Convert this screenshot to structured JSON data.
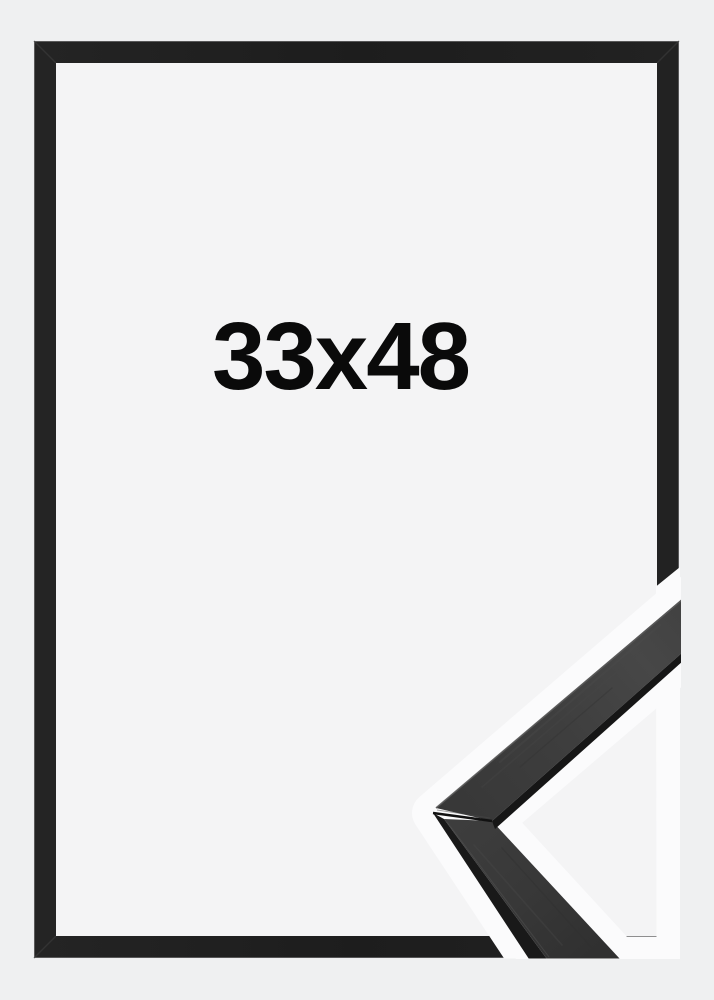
{
  "product": {
    "size_label": "33x48"
  },
  "graphics": {
    "frame_icon": "picture-frame",
    "detail_icon": "frame-corner-moulding-closeup"
  },
  "colors": {
    "page_background": "#eff0f1",
    "frame_black": "#202020",
    "frame_interior": "#f4f4f5",
    "cutout_white": "#fbfbfc",
    "detail_face": "#3e3e3e",
    "detail_side_edge": "#191919",
    "label_text": "#0a0a0a"
  }
}
